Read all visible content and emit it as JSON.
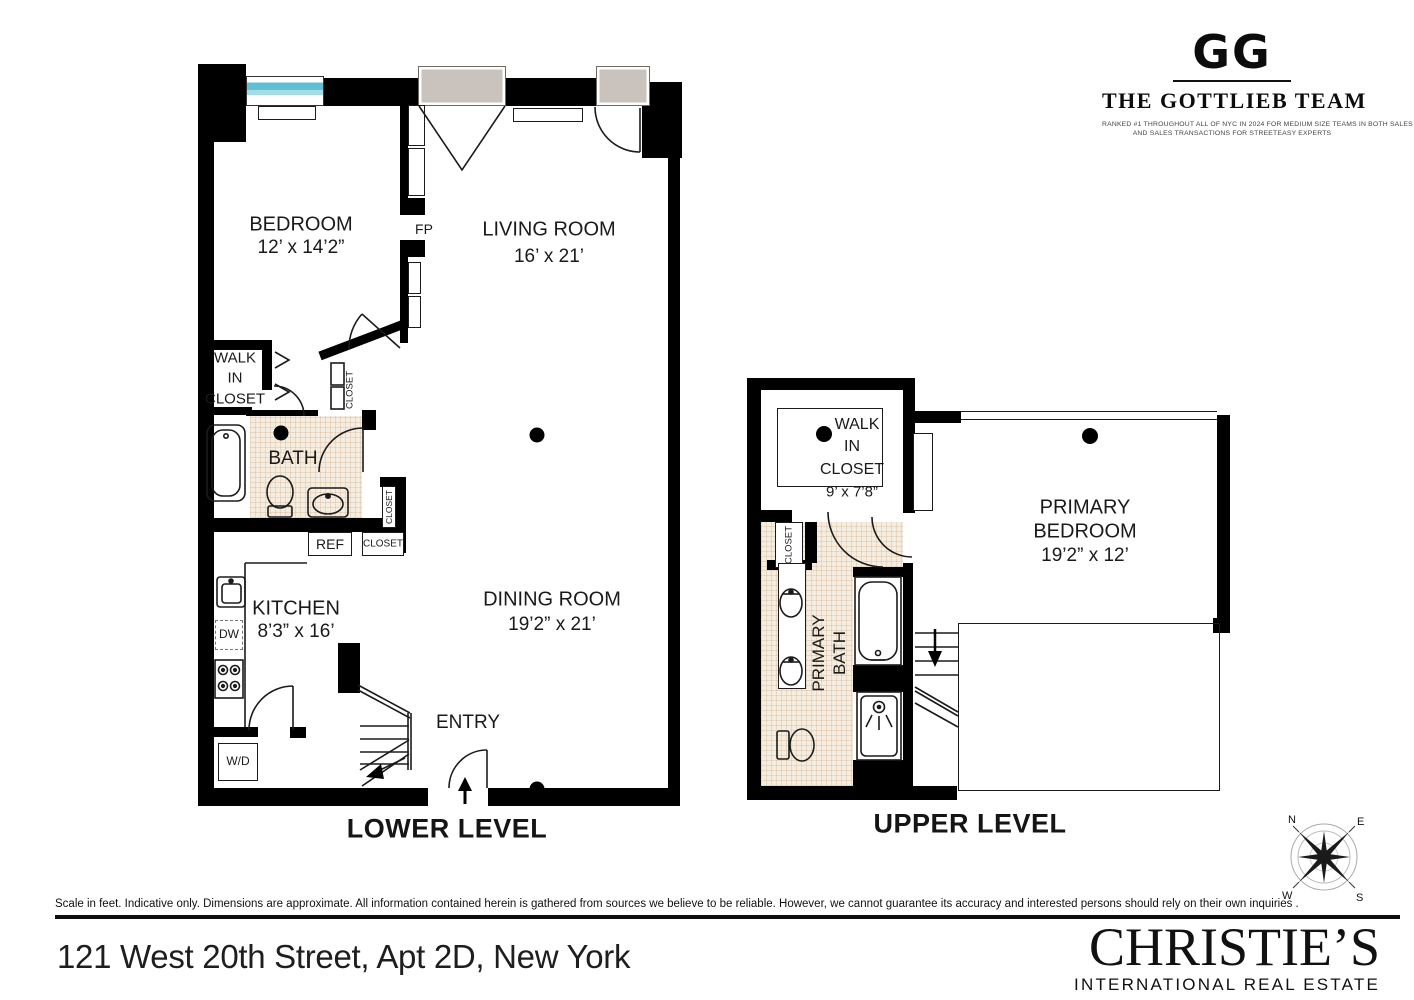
{
  "brand": {
    "monogram": "GG",
    "team_name": "THE GOTTLIEB TEAM",
    "tagline_line1": "RANKED #1 THROUGHOUT ALL OF NYC IN 2024 FOR MEDIUM SIZE TEAMS IN BOTH SALES VOLUME",
    "tagline_line2": "AND SALES TRANSACTIONS FOR STREETEASY EXPERTS"
  },
  "lower_level": {
    "title": "LOWER LEVEL",
    "bedroom_name": "BEDROOM",
    "bedroom_dims": "12’ x 14’2”",
    "living_name": "LIVING ROOM",
    "living_dims": "16’ x 21’",
    "dining_name": "DINING ROOM",
    "dining_dims": "19’2” x 21’",
    "kitchen_name": "KITCHEN",
    "kitchen_dims": "8’3” x 16’",
    "bath_name": "BATH",
    "wic_line1": "WALK",
    "wic_line2": "IN",
    "wic_line3": "CLOSET",
    "entry_name": "ENTRY",
    "fireplace": "FP",
    "fridge": "REF",
    "dishwasher": "DW",
    "washer_dryer": "W/D",
    "closet_angled": "CLOSET",
    "closet_hall": "CLOSET",
    "closet_entry": "CLOSET"
  },
  "upper_level": {
    "title": "UPPER LEVEL",
    "wic_line1": "WALK",
    "wic_line2": "IN",
    "wic_line3": "CLOSET",
    "wic_dims": "9’ x 7’8”",
    "bedroom_line1": "PRIMARY",
    "bedroom_line2": "BEDROOM",
    "bedroom_dims": "19’2” x 12’",
    "bath_line1": "PRIMARY",
    "bath_line2": "BATH",
    "closet": "CLOSET"
  },
  "compass": {
    "north": "N",
    "east": "E",
    "south": "S",
    "west": "W"
  },
  "footer": {
    "disclaimer": "Scale in feet. Indicative only. Dimensions are approximate. All information contained herein is gathered from sources we believe to be reliable. However, we cannot guarantee its accuracy and interested persons should rely on their own inquiries .",
    "address": "121 West 20th Street, Apt 2D, New York",
    "brokerage": "CHRISTIE’S",
    "brokerage_sub": "INTERNATIONAL REAL ESTATE"
  },
  "colors": {
    "wall": "#000000",
    "window_glass": "#5fc0d4",
    "door_panel": "#cac3bd",
    "bath_tile": "#f6ede1"
  }
}
